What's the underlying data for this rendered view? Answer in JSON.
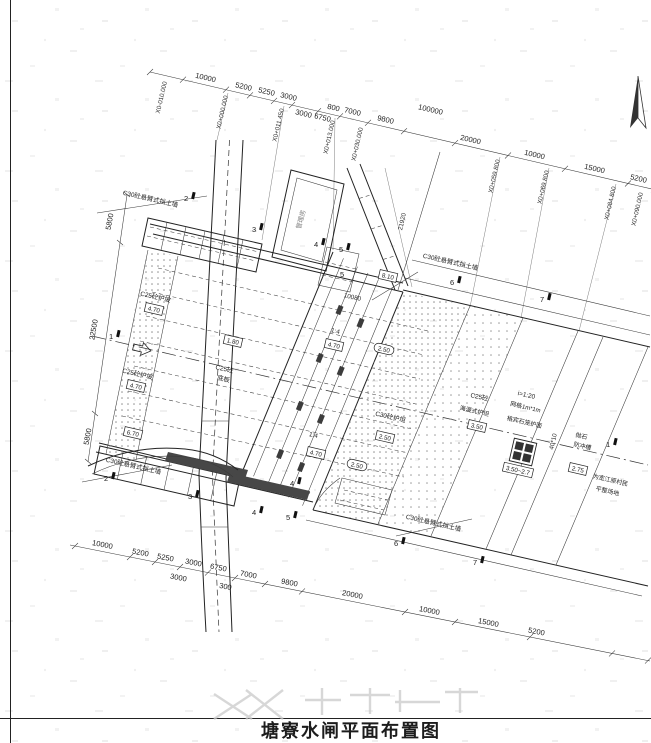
{
  "title": "塘寮水闸平面布置图",
  "colors": {
    "ink": "#222222",
    "dark_fill": "#474747",
    "dots": "#8f8f8f",
    "faint": "#c9c9c9"
  },
  "dims": {
    "top": [
      "10000",
      "5200",
      "5250",
      "3000",
      "3000",
      "6750",
      "800",
      "7000",
      "9800",
      "20000",
      "10000",
      "15000",
      "5200"
    ],
    "top_overall": "100000",
    "stations": [
      "X0-010.000",
      "X0+000.000",
      "X0+011.450",
      "X0+013.000",
      "X0+030.000",
      "X0+059.800",
      "X0+069.800",
      "X0+084.800",
      "X0+090.000"
    ],
    "left": [
      "5800",
      "22500",
      "5800"
    ],
    "bottom": [
      "10000",
      "5200",
      "5250",
      "3000",
      "6750",
      "3000",
      "300",
      "7000",
      "9800",
      "20000",
      "10000",
      "15000",
      "5200"
    ],
    "skew_21920": "21920",
    "skew_10080": "10080",
    "skew_40x10": "40*10"
  },
  "ann": {
    "wall": "C30砼悬臂式挡土墙",
    "slope": "C25砼护坡",
    "slope_ratio": "1:4",
    "floor1": "C25砼",
    "floor2": "底板",
    "apron": "C30砼护坦",
    "haiman1": "C25砼",
    "haiman2": "海漫式护坦",
    "gab1": "i=1:20",
    "gab2": "网格1m*1m",
    "gab3": "格宾石笼护面",
    "rip1": "抛石",
    "rip2": "防冲槽",
    "note1": "为宽江原村民",
    "note2": "平整场地",
    "house": "管理房"
  },
  "elev": {
    "e470": "4.70",
    "e250": "2.50",
    "e810": "8.10",
    "e670": "6.70",
    "e350": "3.50",
    "range": "3.50~2.7",
    "e275": "2.75",
    "e180": "1.80"
  },
  "sections": [
    "1",
    "2",
    "3",
    "4",
    "5",
    "6",
    "7"
  ]
}
